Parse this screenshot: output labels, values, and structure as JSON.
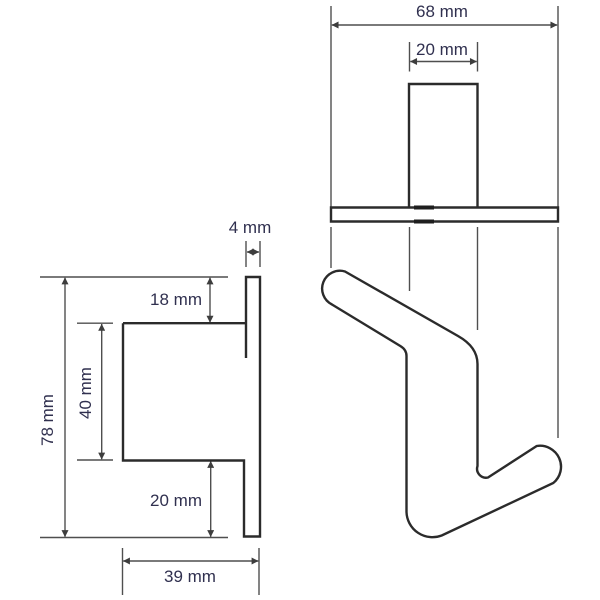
{
  "drawing_type": "technical-dimension-drawing",
  "subject": "wall hook / door hook, two orthographic views",
  "views": {
    "side": {
      "name": "side-view",
      "material_thickness": "4 mm",
      "top_offset": "18 mm",
      "opening_height": "40 mm",
      "overall_height": "78 mm",
      "bottom_offset": "20 mm",
      "depth": "39 mm"
    },
    "front": {
      "name": "front-view",
      "overall_width": "68 mm",
      "bar_width": "20 mm"
    }
  },
  "colors": {
    "background": "#ffffff",
    "outline": "#2b2b2b",
    "dimension_lines": "#4f4f4f",
    "arrowheads": "#3d3d3d",
    "label_text": "#30304f"
  }
}
